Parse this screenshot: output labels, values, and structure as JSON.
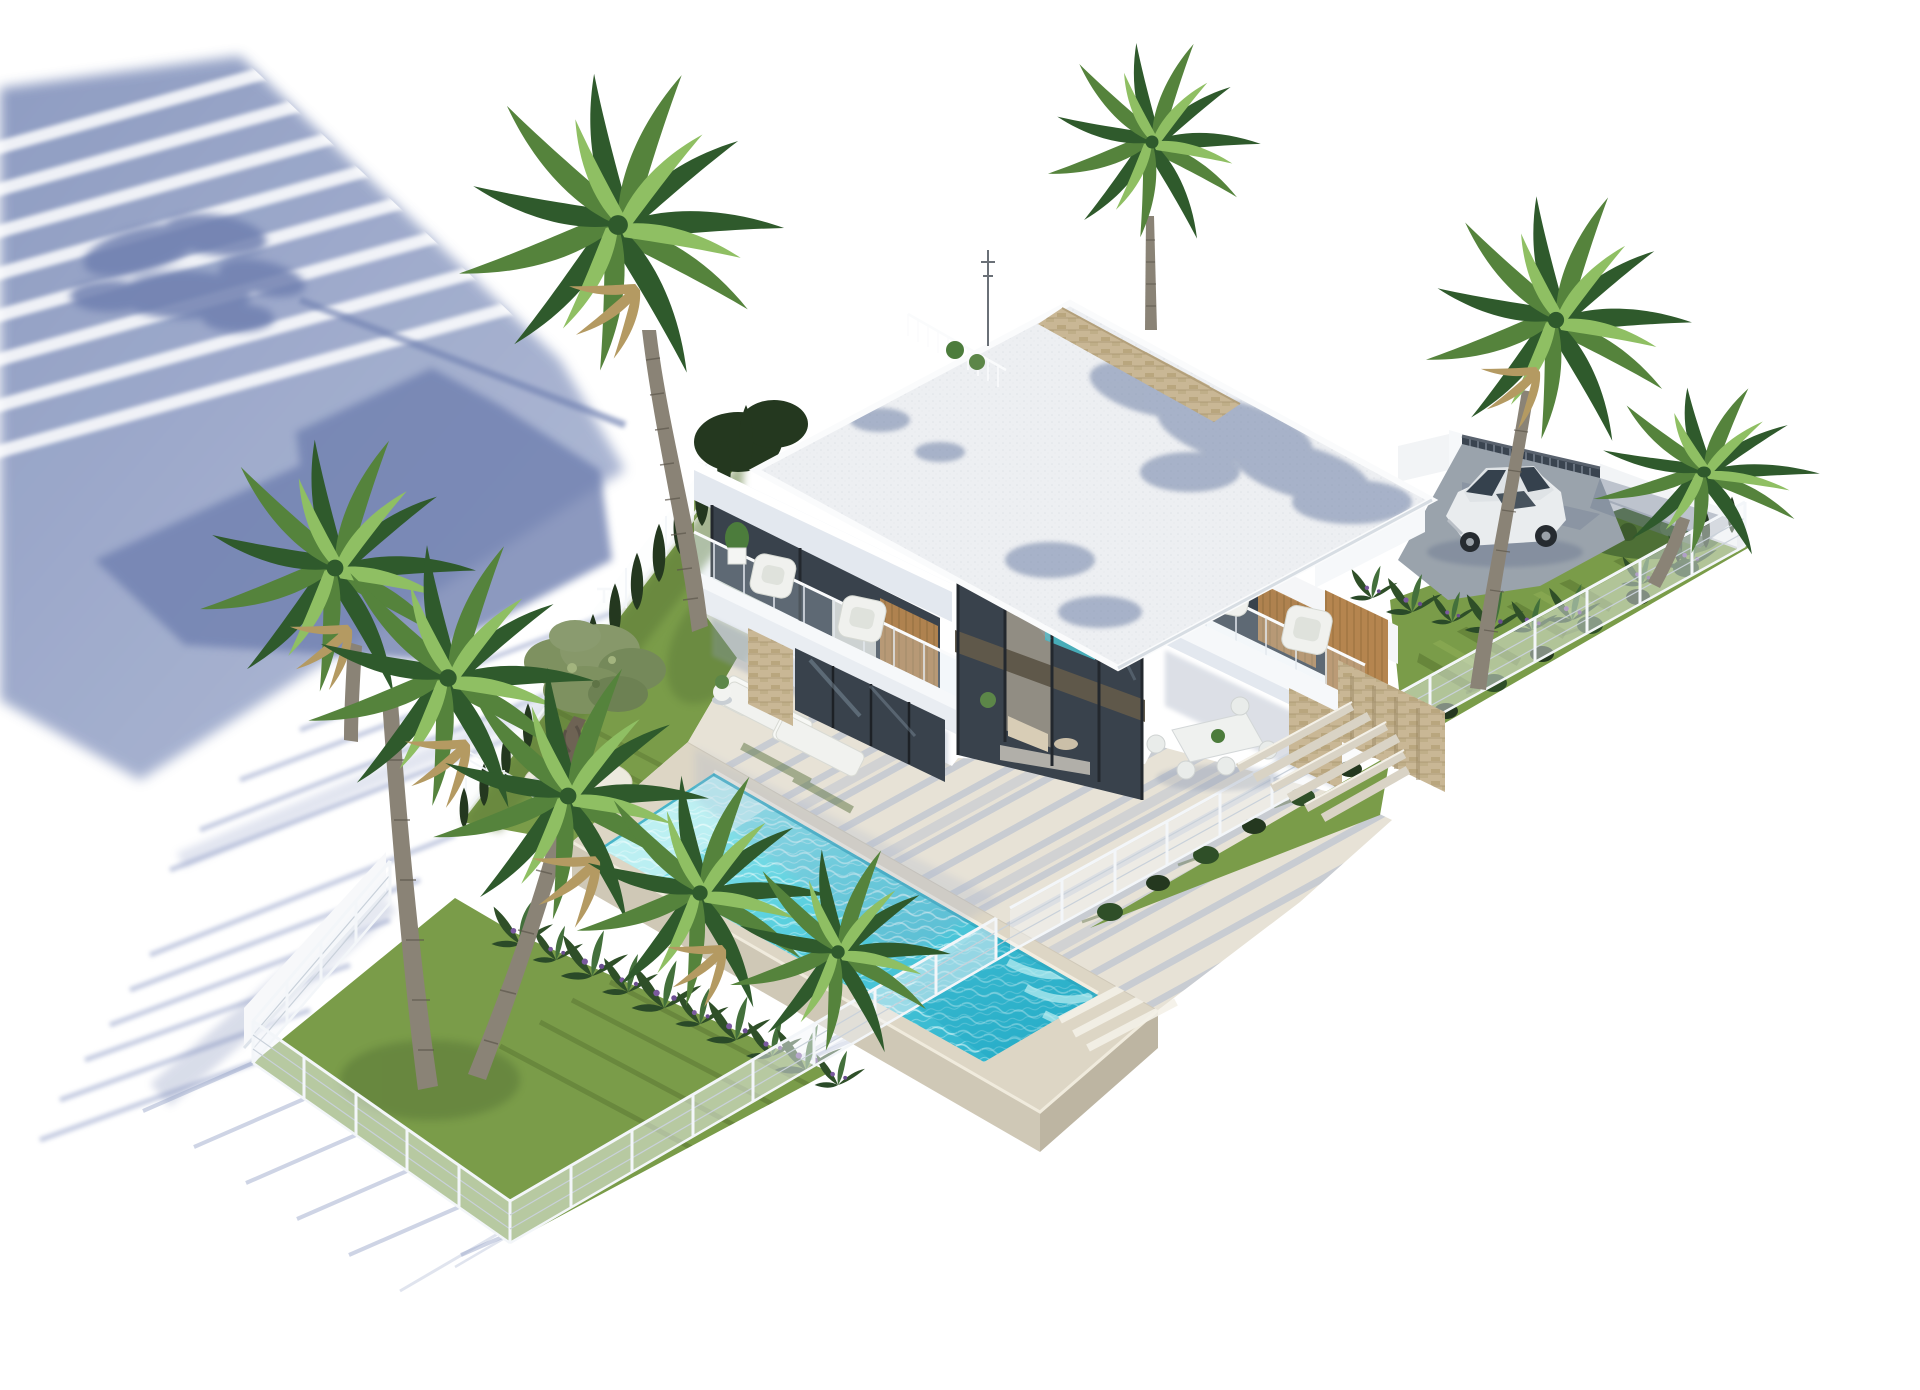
{
  "meta": {
    "type": "architectural-3d-render",
    "subject": "aerial isometric rendering of a modern two-storey white villa on a fenced corner plot",
    "background": "plain white",
    "no_visible_text": true
  },
  "palette": {
    "bg": "#ffffff",
    "shadow_blue": "#8492bd",
    "shadow_blue_deep": "#6f80b0",
    "shadow_blue_light": "#aab5d3",
    "roof_light": "#edeff2",
    "roof_white": "#fafbfc",
    "roof_dapple": "#64779f",
    "wall_white": "#f5f6f8",
    "wall_shade": "#ccd4e2",
    "wall_shade2": "#e3e8ef",
    "glass_dark": "#39424c",
    "glass_frame": "#23282e",
    "wood": "#b5854f",
    "stone_tan": "#c9b795",
    "stone_dark": "#b19e78",
    "terrace": "#e7e2d6",
    "terrace_shade": "#a9b5ce",
    "deck": "#ddd6c5",
    "deck_wall": "#cfc8b6",
    "pool_light": "#b3f0f2",
    "pool_mid": "#5ed2e0",
    "pool_deep": "#2fb4cd",
    "grass": "#7a9c49",
    "grass_light": "#9dbb60",
    "grass_dark": "#55702f",
    "hedge_dark": "#24381f",
    "hedge_mid": "#2f4f28",
    "palm_dark": "#2f5a2c",
    "palm_mid": "#55833c",
    "palm_light": "#8fbf63",
    "palm_dry": "#b49a62",
    "trunk": "#8a8376",
    "trunk_dark": "#5d574c",
    "concrete": "#9aa3ac",
    "gate_dark": "#3a4450",
    "car_body": "#e9ecee",
    "car_glass": "#35414d",
    "fence_white": "#f3f6f9",
    "fence_gray": "#c9d1da",
    "teal_view": "#49b8c4",
    "purple_flower": "#7a5a9e"
  },
  "scene": {
    "shadows": {
      "description": "long blue-violet shadows of the villa, palms and fences cast to the lower-left on white ground, with light stripe gaps"
    },
    "house": {
      "storeys": 2,
      "style": "modern flat-roof white villa",
      "roof": "white gravel flat roof with palm-frond shadow dapple, beige stone parapet band, roof railing, antenna",
      "left_balcony": {
        "armchairs": 2,
        "planter": 1
      },
      "right_balcony": {
        "armchairs": 2,
        "planter": 1,
        "wood_panel": true
      },
      "center": "double-height glazed corner with bronze frames, pool visible through glass, living room interior",
      "ground_floor": "glass sliders, stone-clad pillar and side wall, covered terrace with outdoor dining set"
    },
    "dining_set": {
      "table": 1,
      "chairs": 5
    },
    "sun_loungers": 2,
    "planter_pot": 1,
    "pool": {
      "shape": "rectangular (isometric)",
      "water": "turquoise with ripple texture and light steps",
      "deck": "beige raised platform with retaining walls"
    },
    "olive_tree": {
      "count": 1,
      "base": "white gravel circle"
    },
    "palm_trees": {
      "count": 8,
      "placement": "left chain cluster of 5, one tall beside house, one behind roof, one tall by driveway, one arching at far right"
    },
    "cypress_hedge": {
      "count": 14,
      "placement": "along north-west fence"
    },
    "box_hedge_row": {
      "placement": "inside front-right fence"
    },
    "tropical_plants": {
      "placement": "along pool wall and driveway edge",
      "accent": "purple flowers"
    },
    "lawns": {
      "areas": 3,
      "detail": "mowing stripes"
    },
    "fence": {
      "type": "white mesh panel fence on posts",
      "perimeter": true
    },
    "boundary_wall": {
      "color": "white",
      "placement": "north-east side"
    },
    "gate": {
      "type": "dark vertical-slat sliding gate"
    },
    "driveway": {
      "surface": "grey concrete"
    },
    "car": {
      "count": 1,
      "color": "white",
      "type": "hatchback",
      "parked": "behind gate on driveway"
    }
  }
}
